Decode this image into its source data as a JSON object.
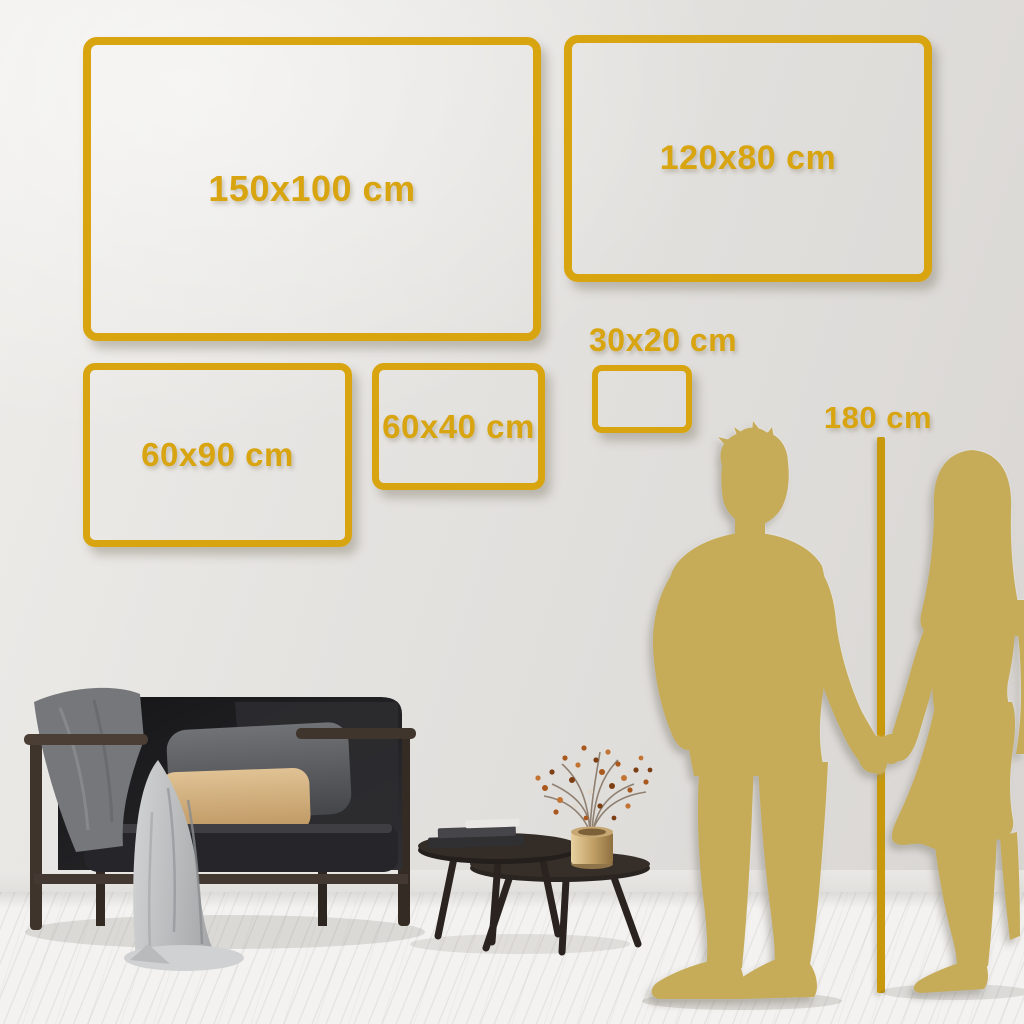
{
  "size_guide": {
    "frames": [
      {
        "size_id": "150x100",
        "label": "150x100 cm"
      },
      {
        "size_id": "120x80",
        "label": "120x80 cm"
      },
      {
        "size_id": "60x90",
        "label": "60x90 cm"
      },
      {
        "size_id": "60x40",
        "label": "60x40 cm"
      },
      {
        "size_id": "30x20",
        "label": "30x20 cm"
      }
    ],
    "height_marker": {
      "label": "180 cm"
    }
  },
  "colors": {
    "accent_gold": "#D8A511",
    "line_gold": "#C8990C",
    "silhouette_gold": "#C6AB58",
    "wall_light": "#EFEDEA",
    "wall_dark": "#D8D5D2",
    "floor": "#F3F2F0"
  },
  "scene": {
    "figures": [
      {
        "name": "man-silhouette"
      },
      {
        "name": "woman-silhouette"
      }
    ],
    "furniture": [
      {
        "name": "sofa"
      },
      {
        "name": "throw-blanket"
      },
      {
        "name": "gray-pillow"
      },
      {
        "name": "beige-pillow"
      },
      {
        "name": "nesting-coffee-tables"
      },
      {
        "name": "books-stack"
      },
      {
        "name": "brass-vase"
      },
      {
        "name": "dried-flower-branch"
      }
    ]
  }
}
